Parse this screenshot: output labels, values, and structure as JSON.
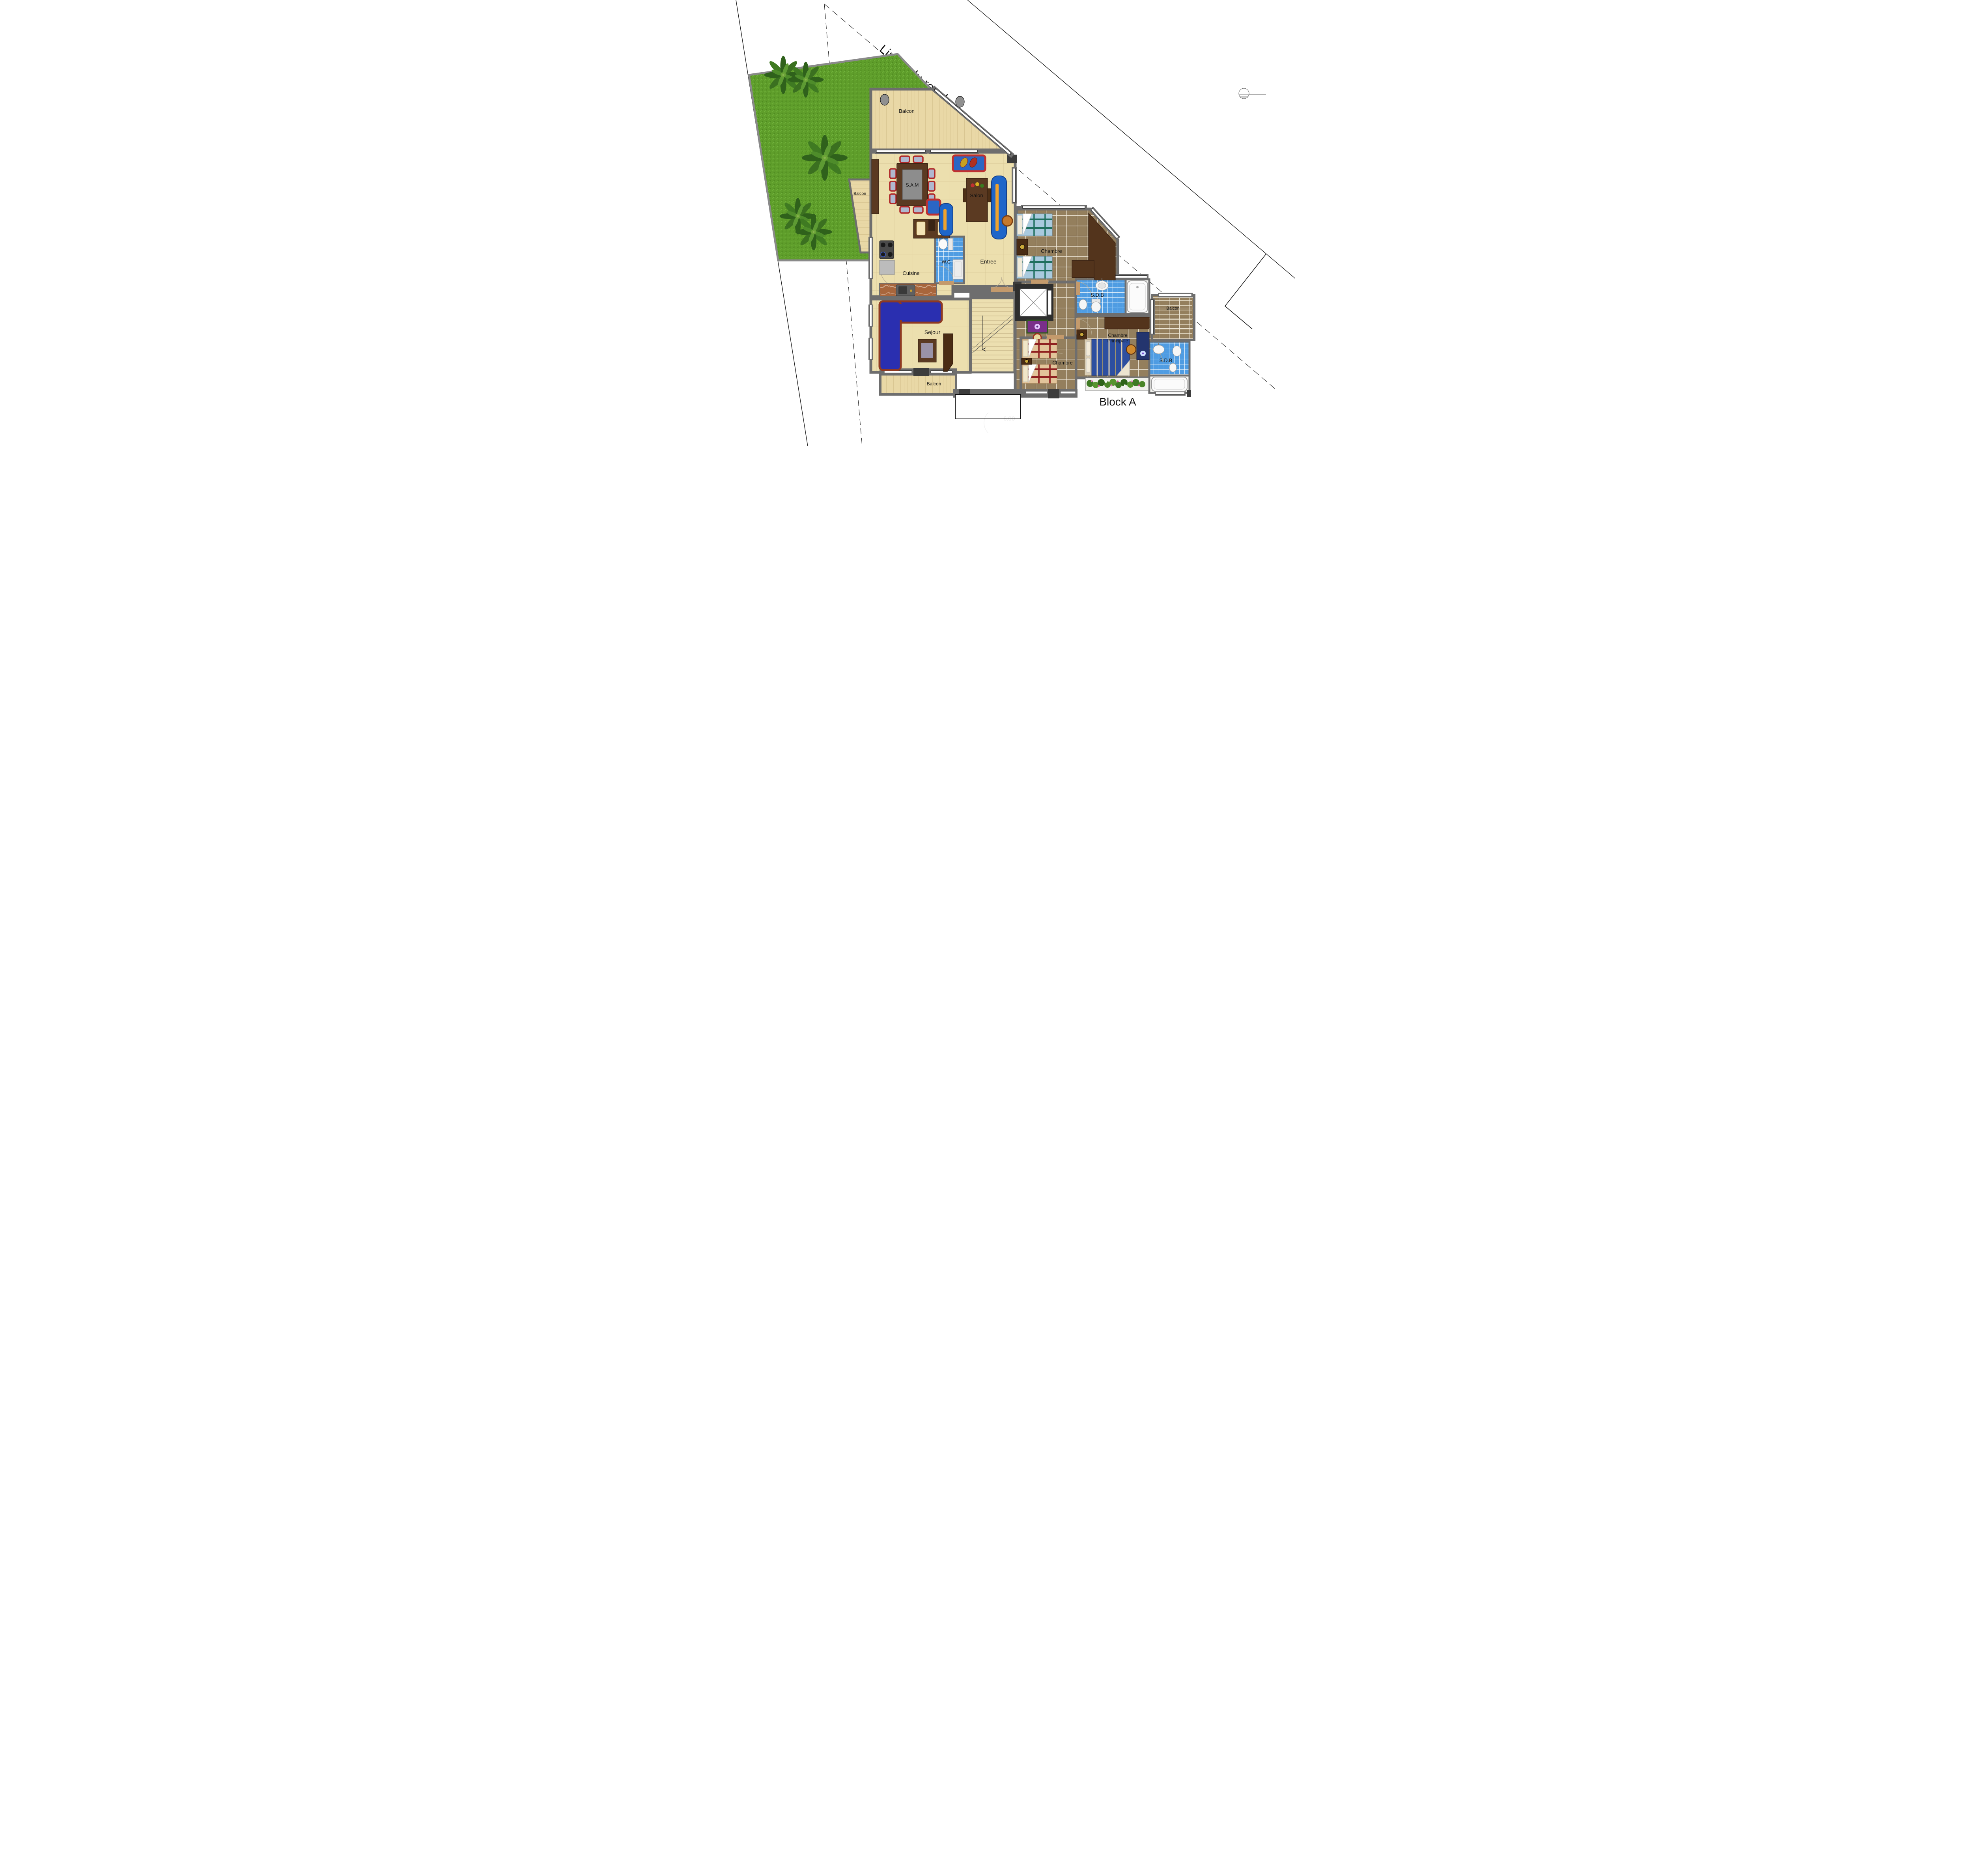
{
  "title": "Block A",
  "boundary": {
    "label": "Limite du recul"
  },
  "labels": {
    "limite": "Limite du recul",
    "balcon_top": "Balcon",
    "balcon_left": "Balcon",
    "balcon_bottom": "Balcon",
    "balcon_right": "Balcon",
    "sam": "S.A.M",
    "salon": "Salon",
    "wc": "W.C",
    "entree": "Entree",
    "cuisine": "Cuisine",
    "sejour": "Sejour",
    "chambre_top": "Chambre",
    "chambre_bottom": "Chambre",
    "sdb_top": "S.D.B",
    "sdb_bottom": "S.D.B",
    "principale_1": "Chambre",
    "principale_2": "Principale",
    "block": "Block A",
    "dim": "6.00"
  },
  "rooms": [
    {
      "id": "balcon-top",
      "label": "Balcon",
      "floor": "wood-plank"
    },
    {
      "id": "balcon-left",
      "label": "Balcon",
      "floor": "wood-plank"
    },
    {
      "id": "salon",
      "label": "Salon",
      "floor": "cream-tile"
    },
    {
      "id": "sam",
      "label": "S.A.M",
      "floor": "cream-tile"
    },
    {
      "id": "cuisine",
      "label": "Cuisine",
      "floor": "cream-tile"
    },
    {
      "id": "wc",
      "label": "W.C",
      "floor": "blue-tile"
    },
    {
      "id": "entree",
      "label": "Entree",
      "floor": "cream-tile"
    },
    {
      "id": "sejour",
      "label": "Sejour",
      "floor": "cream-tile"
    },
    {
      "id": "balcon-bottom",
      "label": "Balcon",
      "floor": "wood-plank"
    },
    {
      "id": "chambre-top",
      "label": "Chambre",
      "floor": "brown-tile"
    },
    {
      "id": "sdb-top",
      "label": "S.D.B",
      "floor": "blue-tile"
    },
    {
      "id": "chambre-principale",
      "label": "Chambre Principale",
      "floor": "brown-tile"
    },
    {
      "id": "balcon-right",
      "label": "Balcon",
      "floor": "brown-tile"
    },
    {
      "id": "chambre-bottom",
      "label": "Chambre",
      "floor": "brown-tile"
    },
    {
      "id": "sdb-bottom",
      "label": "S.D.B",
      "floor": "blue-tile"
    }
  ],
  "colors": {
    "grass": "#5f9e2b",
    "floor_cream": "#ecdfae",
    "floor_plank": "#e9d8a6",
    "tile_brown": "#8f7a5a",
    "tile_blue": "#5aa5e8",
    "wall": "#6e6e6e",
    "wall_dark": "#3c3c3c",
    "wood_dark": "#5b3a22",
    "sofa_blue": "#2a2fb0",
    "sofa_frame_red": "#bf3030",
    "bed_blue": "#a9cade",
    "bed_orange": "#e2c49a",
    "bed_master": "#2d4fa0",
    "fixture_white": "#fbfbfb"
  }
}
